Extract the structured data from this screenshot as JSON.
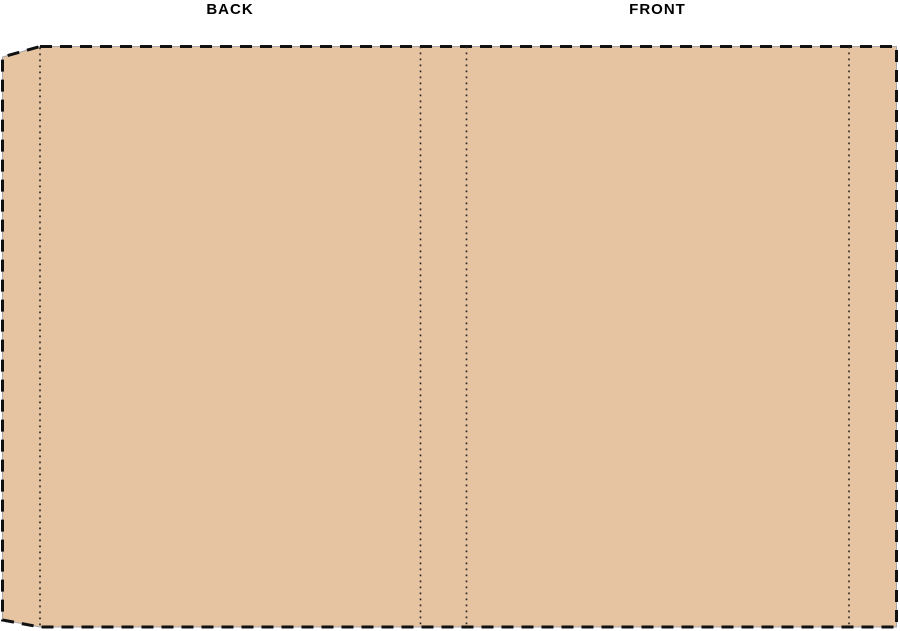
{
  "labels": {
    "back": "BACK",
    "front": "FRONT"
  },
  "colors": {
    "background": "#ffffff",
    "cover_fill": "#E6C3A1",
    "cut_line": "#111111",
    "fold_line": "#222222",
    "edge_line": "#A8A8AC",
    "label_text": "#000000"
  }
}
